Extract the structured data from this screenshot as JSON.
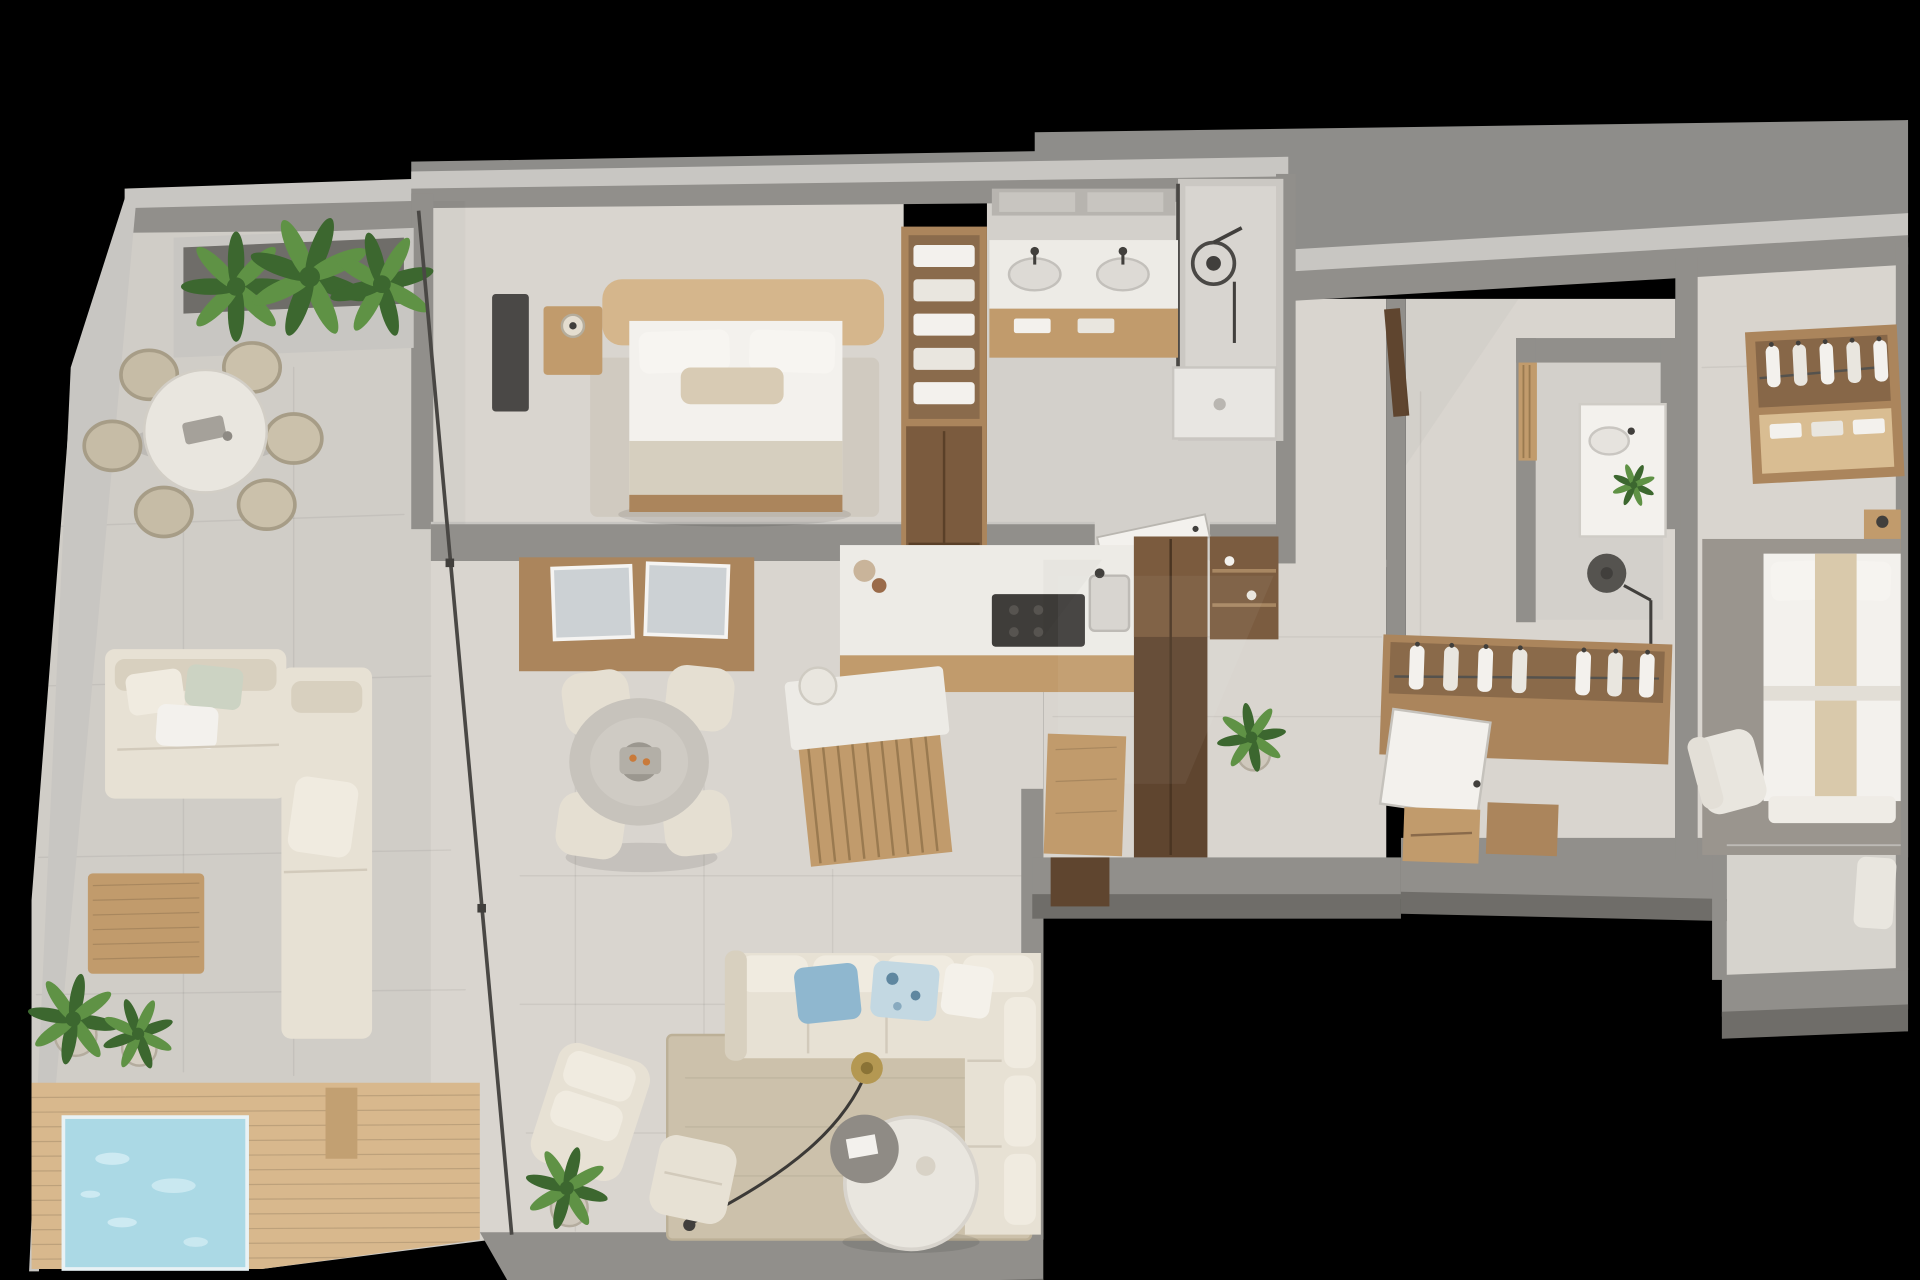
{
  "scene": {
    "title": "3D top-down render of an apartment floor plan on a black background",
    "background": "#000000"
  },
  "palette": {
    "bg": "#000000",
    "ceiling": "#8e8d8a",
    "wall-top": "#c8c6c2",
    "wall-face": "#918f8b",
    "wall-dark": "#6f6d69",
    "floor": "#d9d5cf",
    "floor-marble": "#d3d0cb",
    "floor-terrace": "#d0cdc7",
    "floor-balcony": "#d6d3cd",
    "deck": "#d8b88d",
    "deck-dark": "#c2a072",
    "pool": "#abd9e5",
    "pool-light": "#d6eef5",
    "rug": "#ccc1ab",
    "rug-light": "#d0cac0",
    "rug-gray": "#9a958e",
    "sofa": "#e7e1d4",
    "sofa-shade": "#d8d0bf",
    "cushion": "#f0ebe0",
    "wood": "#c19b6c",
    "wood-light": "#d9bd92",
    "wood-mid": "#ab855c",
    "wood-dark": "#7b5b3e",
    "wood-deep": "#5f452f",
    "white": "#f3f1ed",
    "off-white": "#e9e6df",
    "counter": "#edebe6",
    "fixture": "#413f3c",
    "glass": "#4a4845",
    "pillow-blue": "#8fb7cf",
    "pillow-pattern": "#c3d8e2",
    "plant-dark": "#3c672f",
    "plant-light": "#5f9245",
    "lamp-gold": "#b49852",
    "art-marble": "#ccd1d4",
    "mirror": "#b7b4af",
    "headboard": "#d5b68c",
    "blanket": "#d6cfbf"
  },
  "rooms": [
    {
      "id": "terrace",
      "label": "Terrace with round dining table, six wicker chairs and planter of tropical plants"
    },
    {
      "id": "outdoor-lounge",
      "label": "Outdoor L-shaped lounge sofa with slatted wood coffee table and potted plants"
    },
    {
      "id": "deck-pool",
      "label": "Timber deck with square plunge pool"
    },
    {
      "id": "master-bedroom",
      "label": "Master bedroom with double bed, nightstand, media unit and rug"
    },
    {
      "id": "walk-in-closet",
      "label": "Closet column with folded linen shelves"
    },
    {
      "id": "master-bathroom",
      "label": "En-suite bathroom with double vanity, mirrors and walk-in rain shower"
    },
    {
      "id": "dining-area",
      "label": "Dining area with round marble table, four cream chairs and wood feature wall with two artworks"
    },
    {
      "id": "kitchen",
      "label": "Kitchen with cooktop peninsula, slatted island, stool, tall cabinets and open shelving"
    },
    {
      "id": "living-room",
      "label": "Living room with cream sectional sofa, blue cushions, arc floor lamp, coffee tables, armchair, pouf and rug"
    },
    {
      "id": "hallway",
      "label": "Entrance hallway with wood door and indoor plant"
    },
    {
      "id": "bathroom-2",
      "label": "Second bathroom with vanity, plant and rain shower"
    },
    {
      "id": "hall-wardrobe",
      "label": "Wardrobe wall with hanging clothes, white door and drawer chests"
    },
    {
      "id": "bedroom-2",
      "label": "Second bedroom with open wardrobe of hanging clothes, double bed with beige runner, desk chair and gray rug"
    },
    {
      "id": "balcony",
      "label": "Small balcony off the second bedroom"
    }
  ]
}
